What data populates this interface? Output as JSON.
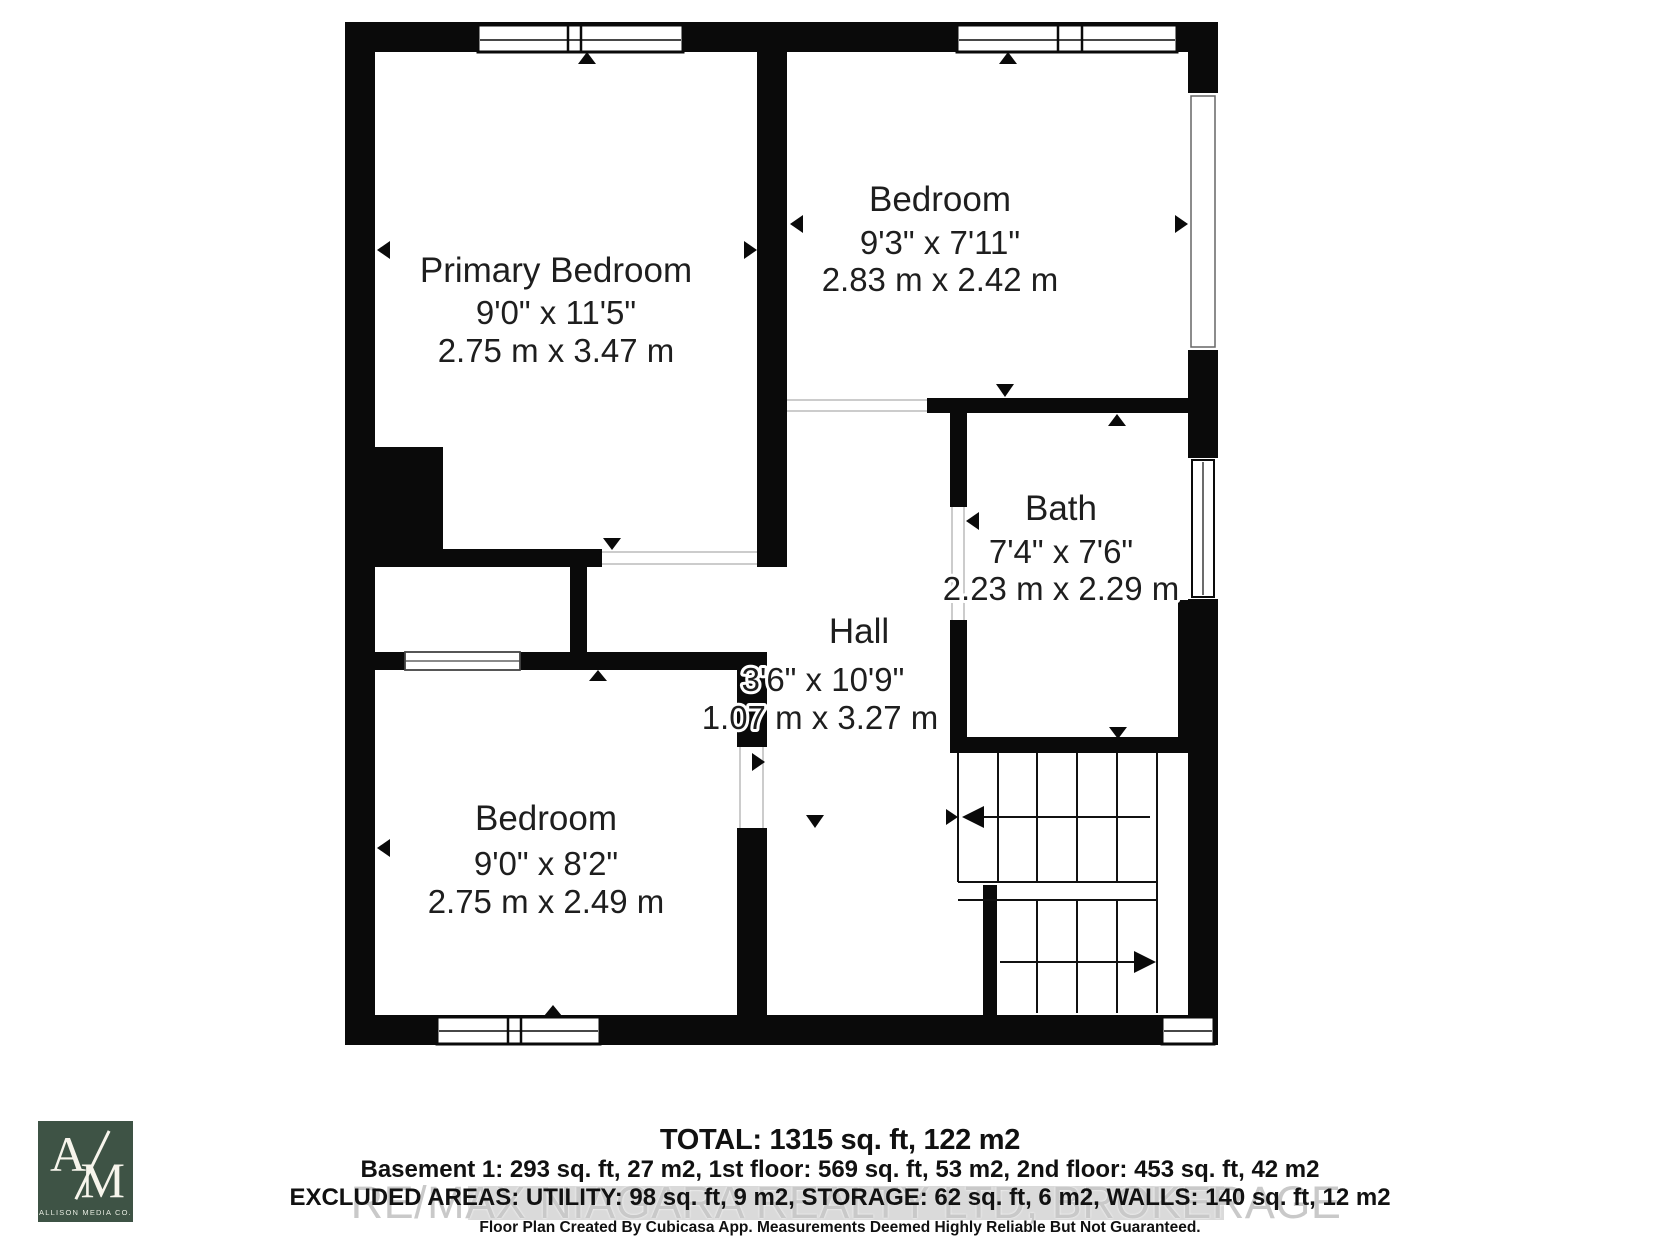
{
  "floorplan": {
    "rooms": [
      {
        "id": "primary-bedroom",
        "name": "Primary Bedroom",
        "imperial": "9'0\" x 11'5\"",
        "metric": "2.75 m x 3.47 m"
      },
      {
        "id": "bedroom-top-right",
        "name": "Bedroom",
        "imperial": "9'3\" x 7'11\"",
        "metric": "2.83 m x 2.42 m"
      },
      {
        "id": "bath",
        "name": "Bath",
        "imperial": "7'4\" x 7'6\"",
        "metric": "2.23 m x 2.29 m"
      },
      {
        "id": "hall",
        "name": "Hall",
        "imperial": "3'6\" x 10'9\"",
        "metric": "1.07 m x 3.27 m"
      },
      {
        "id": "bedroom-bottom-left",
        "name": "Bedroom",
        "imperial": "9'0\" x 8'2\"",
        "metric": "2.75 m x 2.49 m"
      }
    ],
    "icons": {
      "door-marker": "▲",
      "stairs-up-arrow": "◄",
      "stairs-down-arrow": "►"
    },
    "colors": {
      "wall": "#0a0a0a",
      "room_text": "#1e1e1e",
      "watermark_text": "#c9c9c9",
      "watermark_band": "#dadada",
      "logo_bg": "#3e5345",
      "logo_text": "#f7f5ec",
      "footer_text": "#111111"
    }
  },
  "summary": {
    "total": "TOTAL: 1315 sq. ft, 122 m2",
    "floors": "Basement 1: 293 sq. ft, 27 m2, 1st floor: 569 sq. ft, 53 m2, 2nd floor: 453 sq. ft, 42 m2",
    "excluded": "EXCLUDED AREAS: UTILITY: 98 sq. ft, 9 m2, STORAGE: 62 sq. ft, 6 m2, WALLS: 140 sq. ft, 12 m2",
    "disclaimer": "Floor Plan Created By Cubicasa App. Measurements Deemed Highly Reliable But Not Guaranteed."
  },
  "watermark": "RE/MAX NIAGARA REALTY LTD, BROKERAGE",
  "logo": {
    "monogram_top": "A",
    "monogram_bottom": "M",
    "company": "ALLISON MEDIA CO."
  }
}
